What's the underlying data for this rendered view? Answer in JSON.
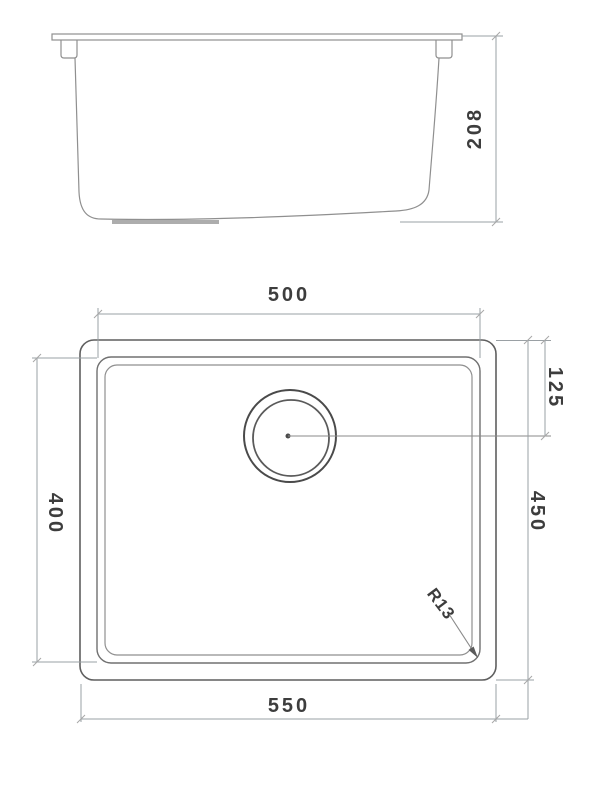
{
  "drawing": {
    "side_view": {
      "height_dim_label": "208"
    },
    "plan_view": {
      "bowl_width_label": "500",
      "overall_width_label": "550",
      "bowl_length_label": "400",
      "overall_length_label": "450",
      "drain_offset_label": "125",
      "corner_radius_label": "R13"
    },
    "colors": {
      "outline": "#5f5f5f",
      "dimension_line": "#9aa0a4",
      "text": "#3d3d3d",
      "background": "#ffffff"
    }
  }
}
